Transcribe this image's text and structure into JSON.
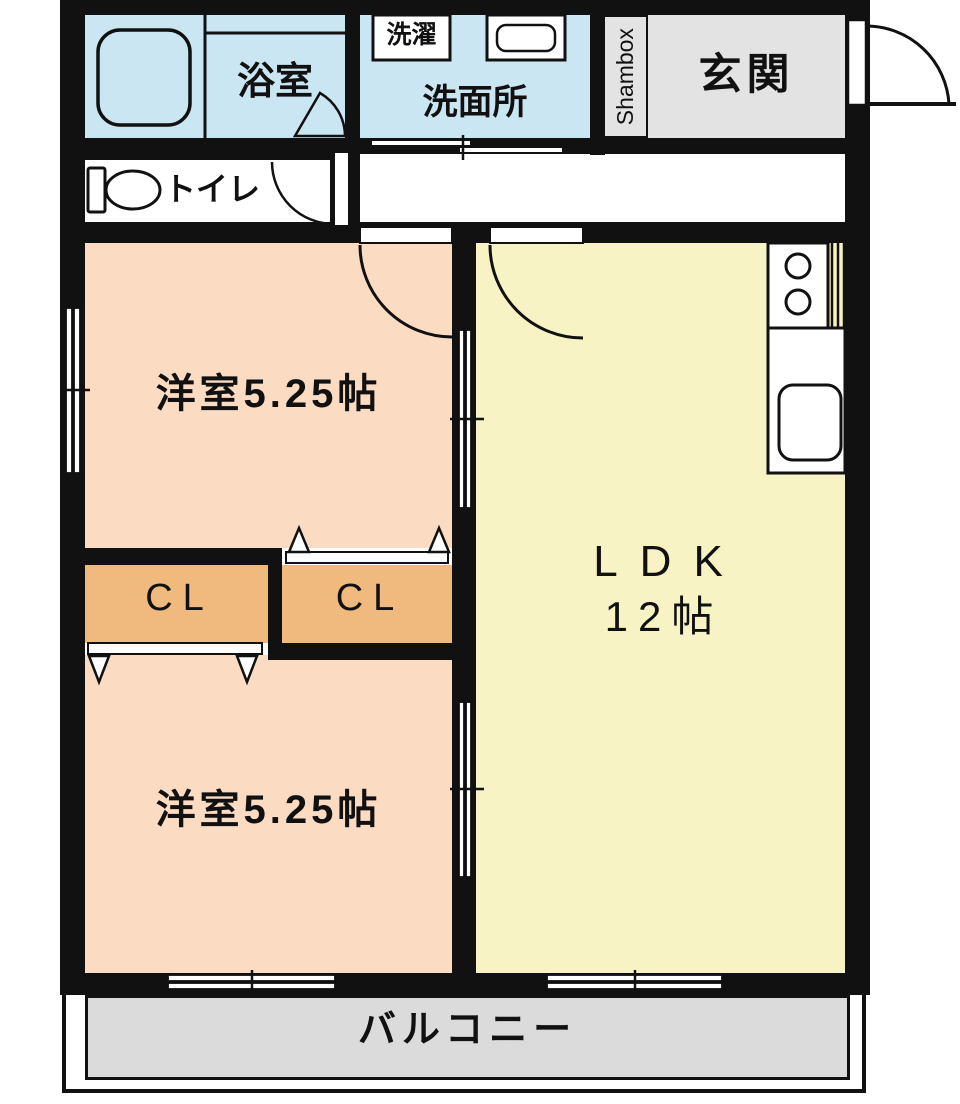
{
  "plan_title": "2LDK apartment floor plan",
  "rooms": {
    "bath": {
      "label": "浴室"
    },
    "washroom": {
      "label": "洗面所"
    },
    "laundry": {
      "label": "洗濯"
    },
    "shoebox": {
      "label": "Shambox"
    },
    "entrance": {
      "label": "玄関"
    },
    "toilet": {
      "label": "トイレ"
    },
    "western_room_1": {
      "label": "洋室5.25帖"
    },
    "western_room_2": {
      "label": "洋室5.25帖"
    },
    "closet_left": {
      "label": "CL"
    },
    "closet_right": {
      "label": "CL"
    },
    "ldk": {
      "label": "LDK",
      "size": "12帖"
    },
    "balcony": {
      "label": "バルコニー"
    }
  },
  "colors": {
    "wall": "#111111",
    "wet_area_blue": "#cbe6f3",
    "room_peach": "#fbdcc2",
    "closet_orange": "#f0ba7e",
    "ldk_yellow": "#f8f3c5",
    "entrance_gray": "#e3e3e3",
    "balcony_gray": "#dbdbdb"
  }
}
